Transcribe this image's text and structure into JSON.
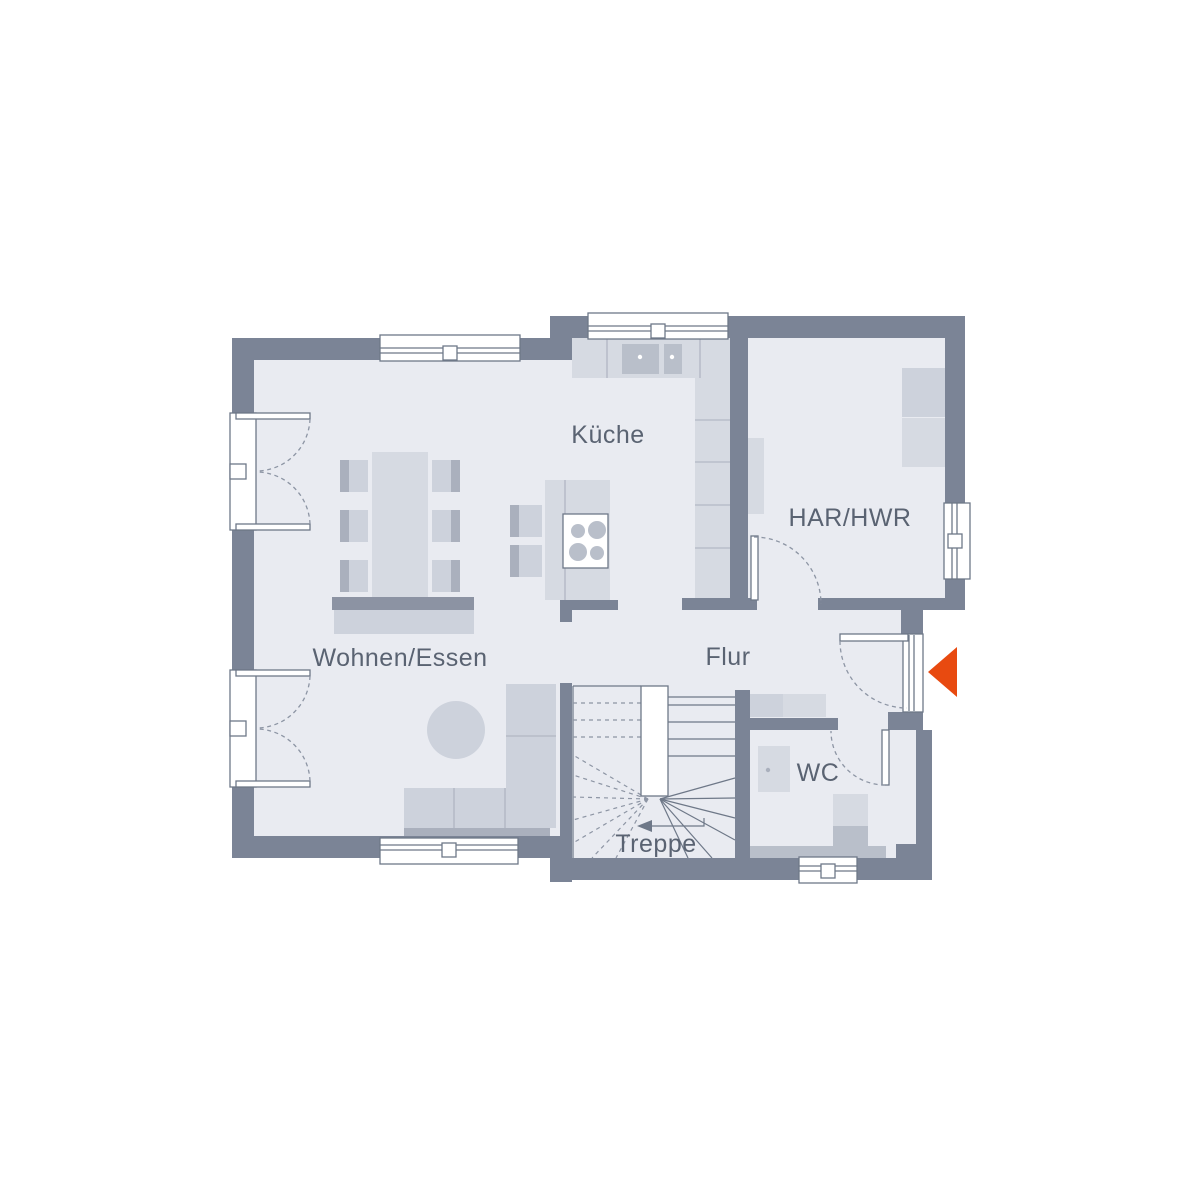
{
  "page": {
    "background": "#ffffff"
  },
  "plan": {
    "rooms": {
      "kueche": {
        "label": "Küche"
      },
      "har_hwr": {
        "label": "HAR/HWR"
      },
      "wohnen_essen": {
        "label": "Wohnen/Essen"
      },
      "flur": {
        "label": "Flur"
      },
      "wc": {
        "label": "WC"
      },
      "treppe": {
        "label": "Treppe"
      }
    },
    "icons": {
      "entrance_arrow": "entrance-arrow",
      "stairs_direction_arrow": "stairs-direction-arrow"
    },
    "colors": {
      "wall": "#7b8496",
      "floor": "#e9ebf1",
      "furniture_light": "#d6dae2",
      "furniture_mid": "#cdd2dc",
      "furniture_dark": "#aab0bd",
      "fixture": "#b9bfca",
      "sideboard": "#8c93a3",
      "outline": "#6e7888",
      "dashed": "#8d95a4",
      "label_text": "#5a6372",
      "accent_orange": "#e84a10",
      "white": "#ffffff"
    }
  }
}
